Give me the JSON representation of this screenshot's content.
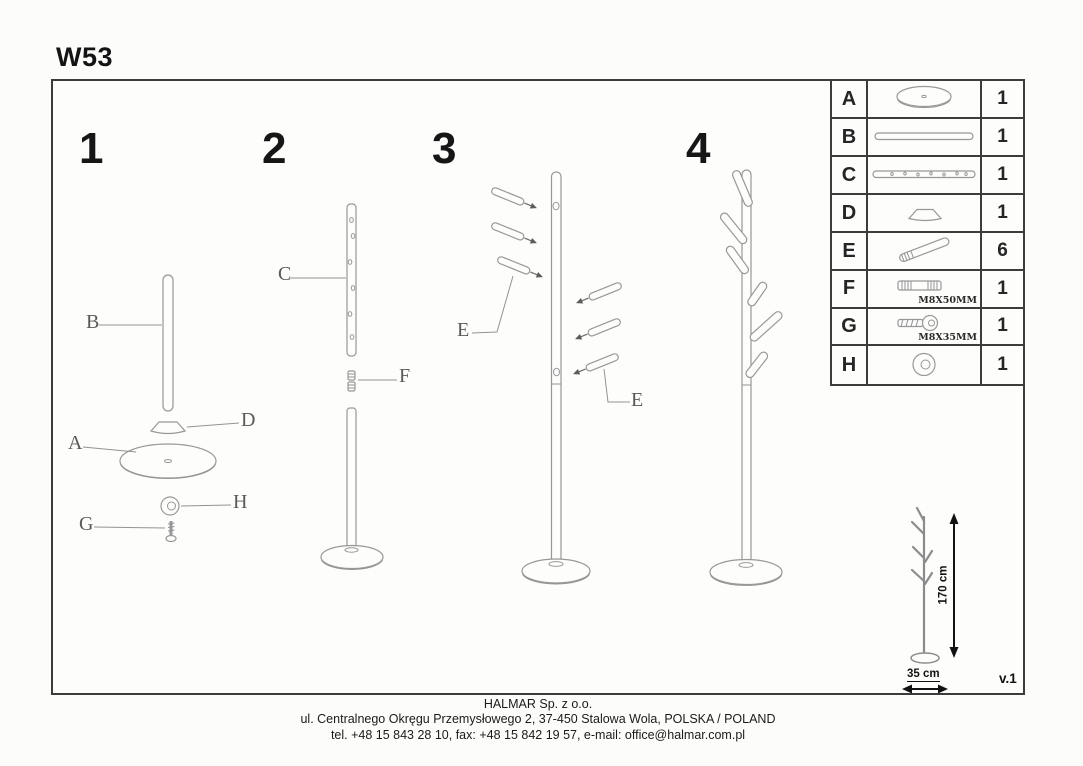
{
  "title": "W53",
  "version": "v.1",
  "steps": [
    {
      "number": "1"
    },
    {
      "number": "2"
    },
    {
      "number": "3"
    },
    {
      "number": "4"
    }
  ],
  "diagram_labels": {
    "step1": {
      "b": "B",
      "d": "D",
      "a": "A",
      "h": "H",
      "g": "G"
    },
    "step2": {
      "c": "C",
      "f": "F"
    },
    "step3": {
      "e_left": "E",
      "e_right": "E"
    }
  },
  "parts_table": {
    "rows": [
      {
        "id": "A",
        "icon": "base-disc-icon",
        "qty": "1"
      },
      {
        "id": "B",
        "icon": "lower-pole-icon",
        "qty": "1"
      },
      {
        "id": "C",
        "icon": "upper-pole-icon",
        "qty": "1"
      },
      {
        "id": "D",
        "icon": "cap-icon",
        "qty": "1"
      },
      {
        "id": "E",
        "icon": "hook-peg-icon",
        "qty": "6"
      },
      {
        "id": "F",
        "icon": "double-bolt-icon",
        "qty": "1",
        "spec": "M8X50MM"
      },
      {
        "id": "G",
        "icon": "screw-icon",
        "qty": "1",
        "spec": "M8X35MM"
      },
      {
        "id": "H",
        "icon": "washer-icon",
        "qty": "1"
      }
    ]
  },
  "dimensions": {
    "height": "170 cm",
    "width": "35 cm"
  },
  "footer": {
    "line1": "HALMAR Sp. z o.o.",
    "line2": "ul. Centralnego Okręgu Przemysłowego 2, 37-450 Stalowa Wola, POLSKA / POLAND",
    "line3": "tel. +48 15 843 28 10, fax: +48 15 842 19 57, e-mail: office@halmar.com.pl"
  }
}
